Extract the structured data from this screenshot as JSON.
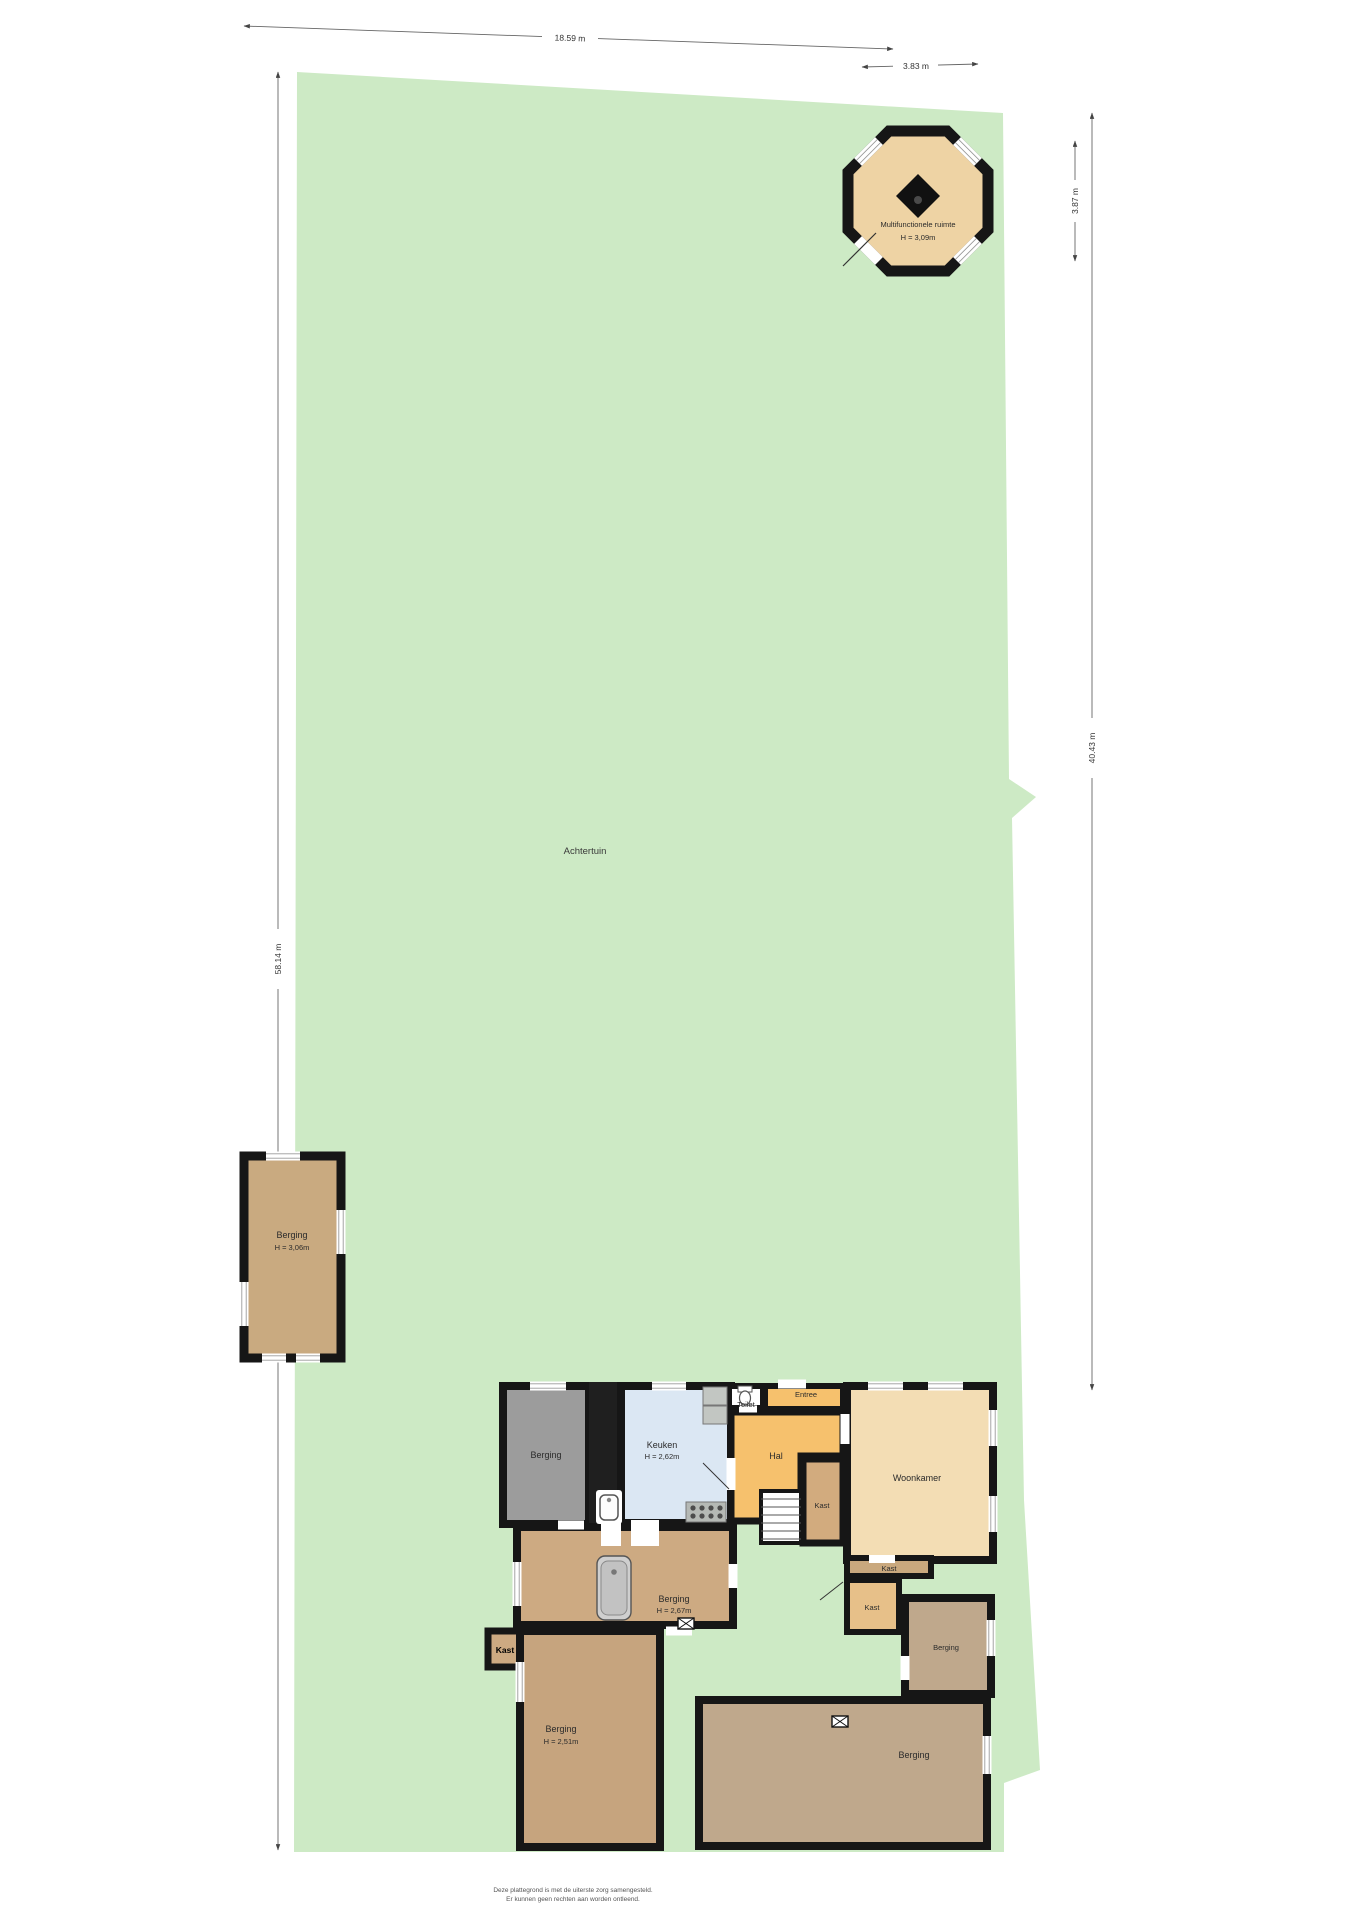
{
  "garden": {
    "label": "Achtertuin"
  },
  "dimensions": {
    "top": "18.59 m",
    "top_right": "3.83 m",
    "right_small": "3.87 m",
    "right_large": "40.43 m",
    "left": "58.14 m"
  },
  "octagon": {
    "name": "Multifunctionele ruimte",
    "height": "H = 3,09m"
  },
  "shed": {
    "name": "Berging",
    "height": "H = 3,06m"
  },
  "house": {
    "rooms": {
      "berging_annex": {
        "name": "Berging"
      },
      "keuken": {
        "name": "Keuken",
        "height": "H = 2,62m"
      },
      "toilet": {
        "name": "Toilet"
      },
      "entree": {
        "name": "Entree"
      },
      "hal": {
        "name": "Hal"
      },
      "kast_a": {
        "name": "Kast"
      },
      "kast_b": {
        "name": "Kast"
      },
      "kast_c": {
        "name": "Kast"
      },
      "kast_bold": {
        "name": "Kast"
      },
      "woonkamer": {
        "name": "Woonkamer"
      },
      "berging_mid": {
        "name": "Berging",
        "height": "H = 2,67m"
      },
      "berging_mid_right": {
        "name": "Berging"
      },
      "berging_bottom_left": {
        "name": "Berging",
        "height": "H = 2,51m"
      },
      "berging_bottom_right": {
        "name": "Berging"
      }
    }
  },
  "footer": {
    "line1": "Deze plattegrond is met de uiterste zorg samengesteld.",
    "line2": "Er kunnen geen rechten aan worden ontleend."
  },
  "colors": {
    "garden": "#cdeac5",
    "wall": "#161616",
    "gray_room": "#9c9c9c",
    "keuken": "#dbe7f3",
    "orange": "#f6c16d",
    "woonkamer": "#f3ddb4",
    "octagon": "#eed3a4",
    "shed": "#c9aa80",
    "berging_mid": "#cdaa82",
    "berging_muted": "#bfa88c",
    "berging_bl": "#c6a47e",
    "kast_a": "#d2ab7e",
    "kast_b": "#c9a87e",
    "kast_c": "#e7c089"
  }
}
